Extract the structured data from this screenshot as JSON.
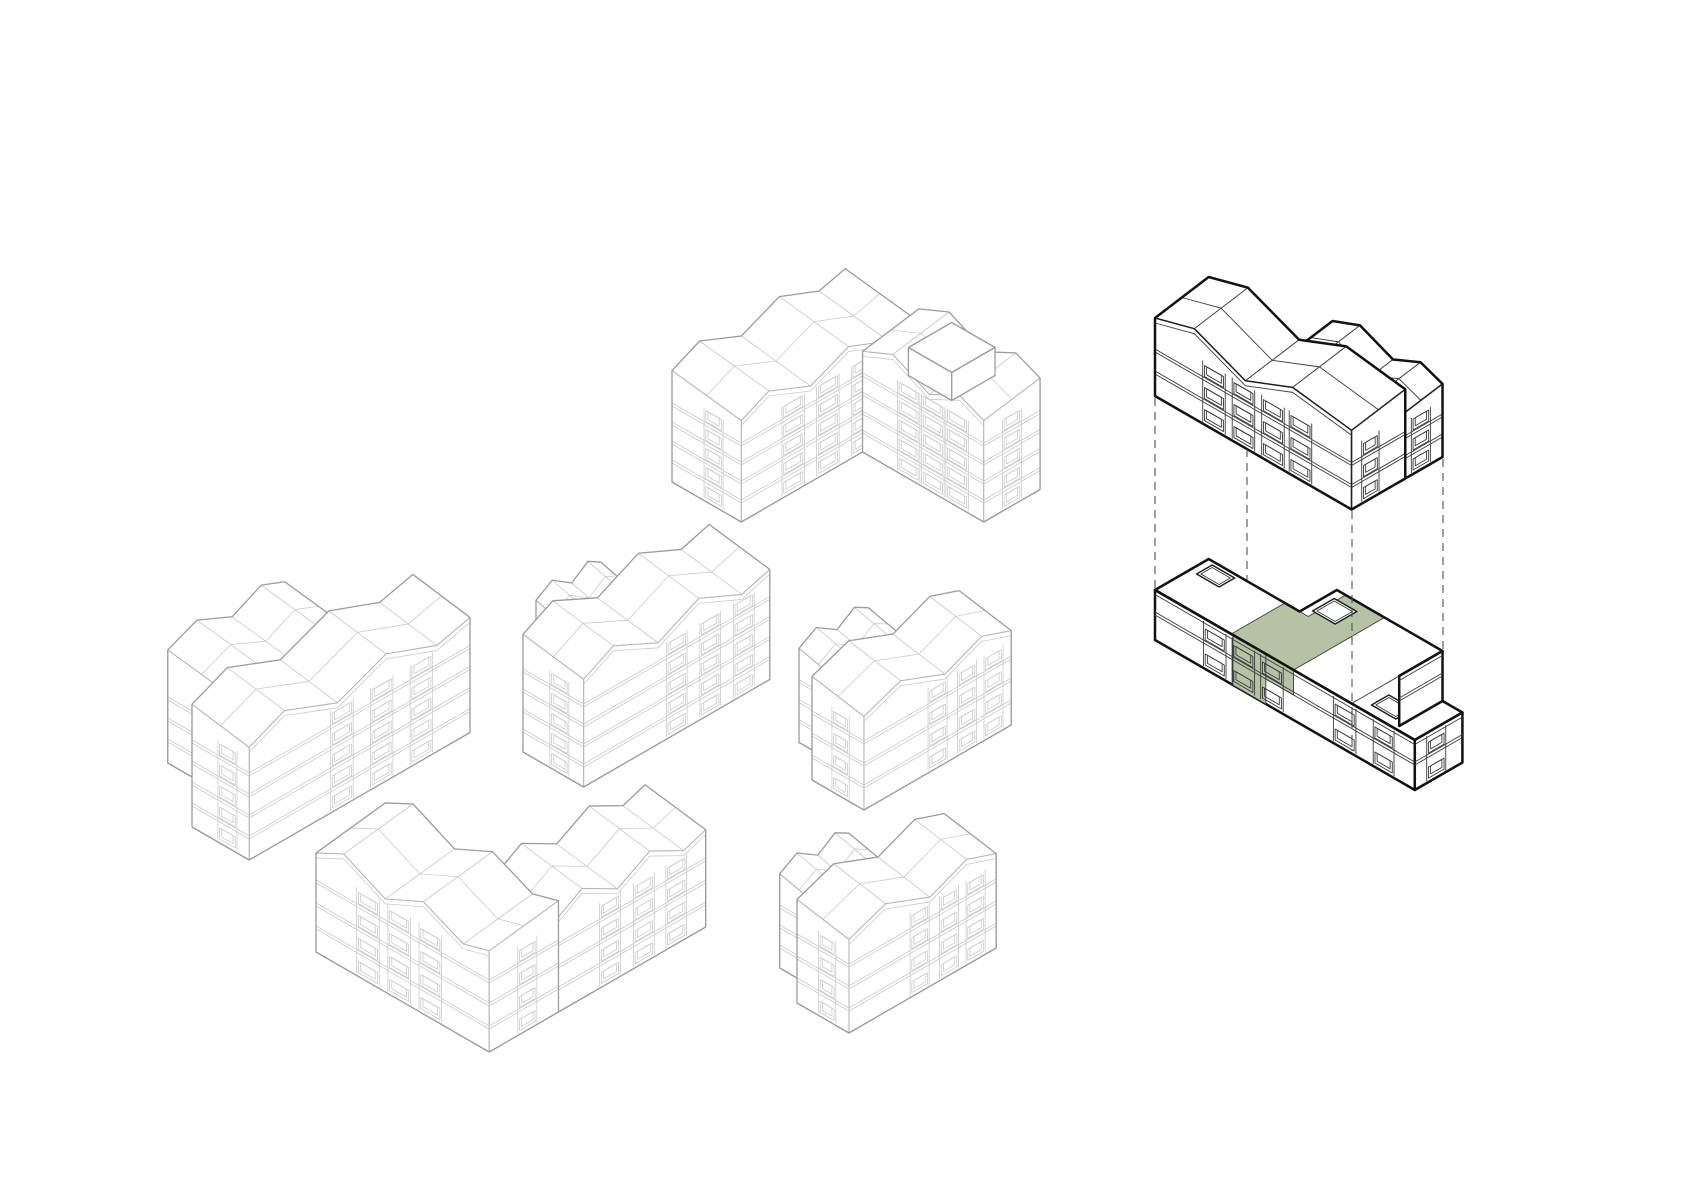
{
  "canvas": {
    "width": 1683,
    "height": 1190,
    "background": "#ffffff"
  },
  "projection": {
    "ax": 0.866,
    "ay": 0.5,
    "bx": 0.866,
    "by": -0.5
  },
  "styles": {
    "light": {
      "line": "#cbcbcb",
      "lwLine": 0.8,
      "edge": "#b4b4b4",
      "lwEdge": 1.05,
      "outline": "#9c9c9c",
      "lwOutline": 1.3
    },
    "dark": {
      "line": "#3b3b3b",
      "lwLine": 0.9,
      "edge": "#1f1f1f",
      "lwEdge": 1.5,
      "outline": "#121212",
      "lwOutline": 2.5
    },
    "highlight": {
      "fill": "#b5c2a3"
    },
    "dash": {
      "color": "#505050",
      "lw": 1.1,
      "pattern": "8 6"
    },
    "faceFill": "#ffffff"
  },
  "roof_profiles": {
    "long": [
      [
        0,
        0.32
      ],
      [
        0.16,
        1
      ],
      [
        0.4,
        0.05
      ],
      [
        0.62,
        0.92
      ],
      [
        0.85,
        0.05
      ],
      [
        1,
        0.42
      ]
    ],
    "short": [
      [
        0,
        0.28
      ],
      [
        0.25,
        1
      ],
      [
        0.55,
        0.06
      ],
      [
        0.8,
        0.88
      ],
      [
        1,
        0.32
      ]
    ],
    "gmain": [
      [
        0,
        0.5
      ],
      [
        0.2,
        1
      ],
      [
        0.46,
        0.06
      ],
      [
        0.7,
        0.92
      ],
      [
        1,
        0.55
      ]
    ]
  },
  "buildings": [
    {
      "id": "north-block",
      "style": "light",
      "anchor": [
        672,
        482
      ],
      "masses": [
        {
          "type": "slab",
          "axis": "b",
          "u": [
            0,
            200
          ],
          "v": [
            0,
            80
          ],
          "H": 95,
          "rise": 20,
          "tilt": 10,
          "floors": 5,
          "fh": 19,
          "profile": "long",
          "stacks": [
            {
              "face": "front",
              "t": 0.3,
              "hw": 13
            },
            {
              "face": "front",
              "t": 0.5,
              "hw": 13
            },
            {
              "face": "front",
              "t": 0.7,
              "hw": 13
            },
            {
              "face": "gable",
              "t": 0.4,
              "hw": 11
            }
          ]
        },
        {
          "type": "slab",
          "axis": "a",
          "u": [
            80,
            220
          ],
          "v": [
            140,
            205
          ],
          "H": 95,
          "rise": 20,
          "tilt": 10,
          "floors": 5,
          "fh": 19,
          "profile": "short",
          "stacks": [
            {
              "face": "front",
              "t": 0.38,
              "hw": 13
            },
            {
              "face": "front",
              "t": 0.58,
              "hw": 13
            },
            {
              "face": "front",
              "t": 0.78,
              "hw": 13
            },
            {
              "face": "gable",
              "t": 0.5,
              "hw": 11
            }
          ]
        },
        {
          "type": "flat",
          "outline": [
            [
              125,
              148
            ],
            [
              175,
              148
            ],
            [
              175,
              198
            ],
            [
              125,
              198
            ]
          ],
          "z0": 95,
          "H": 28,
          "floors": 0,
          "fh": 0,
          "facades": [
            {
              "a0": 125,
              "a1": 175,
              "b": 148,
              "stacks": []
            }
          ],
          "gables": [
            {
              "a": 175,
              "b0": 148,
              "b1": 198,
              "stacks": []
            }
          ]
        }
      ]
    },
    {
      "id": "west-block",
      "style": "light",
      "anchor": [
        192,
        827
      ],
      "masses": [
        {
          "type": "slab",
          "axis": "b",
          "u": [
            50,
            185
          ],
          "v": [
            -78,
            0
          ],
          "H": 98,
          "rise": 18,
          "tilt": 10,
          "floors": 4,
          "fh": 21,
          "profile": "short",
          "stacks": []
        },
        {
          "type": "slab",
          "axis": "b",
          "u": [
            0,
            255
          ],
          "v": [
            0,
            66
          ],
          "H": 105,
          "rise": 24,
          "tilt": 10,
          "floors": 5,
          "fh": 21,
          "profile": "long",
          "stacks": [
            {
              "face": "front",
              "t": 0.42,
              "hw": 13
            },
            {
              "face": "front",
              "t": 0.6,
              "hw": 13
            },
            {
              "face": "front",
              "t": 0.78,
              "hw": 13
            },
            {
              "face": "gable",
              "t": 0.38,
              "hw": 11
            }
          ]
        }
      ]
    },
    {
      "id": "center-block",
      "style": "light",
      "anchor": [
        523,
        752
      ],
      "masses": [
        {
          "type": "slab",
          "axis": "b",
          "u": [
            55,
            130
          ],
          "v": [
            -40,
            0
          ],
          "H": 90,
          "rise": 15,
          "tilt": 10,
          "floors": 4,
          "fh": 20,
          "profile": "short",
          "stacks": []
        },
        {
          "type": "slab",
          "axis": "b",
          "u": [
            0,
            215
          ],
          "v": [
            0,
            70
          ],
          "H": 100,
          "rise": 24,
          "tilt": 10,
          "floors": 5,
          "fh": 20,
          "profile": "long",
          "stacks": [
            {
              "face": "front",
              "t": 0.5,
              "hw": 12
            },
            {
              "face": "front",
              "t": 0.68,
              "hw": 12
            },
            {
              "face": "front",
              "t": 0.86,
              "hw": 12
            },
            {
              "face": "gable",
              "t": 0.4,
              "hw": 11
            }
          ]
        }
      ]
    },
    {
      "id": "east-block",
      "style": "light",
      "anchor": [
        812,
        780
      ],
      "masses": [
        {
          "type": "slab",
          "axis": "b",
          "u": [
            30,
            110
          ],
          "v": [
            -45,
            0
          ],
          "H": 80,
          "rise": 15,
          "tilt": 10,
          "floors": 4,
          "fh": 20,
          "profile": "short",
          "stacks": []
        },
        {
          "type": "slab",
          "axis": "b",
          "u": [
            0,
            170
          ],
          "v": [
            0,
            60
          ],
          "H": 88,
          "rise": 20,
          "tilt": 10,
          "floors": 4,
          "fh": 22,
          "profile": "short",
          "stacks": [
            {
              "face": "front",
              "t": 0.5,
              "hw": 11
            },
            {
              "face": "front",
              "t": 0.7,
              "hw": 11
            },
            {
              "face": "front",
              "t": 0.88,
              "hw": 11
            },
            {
              "face": "gable",
              "t": 0.45,
              "hw": 10
            }
          ]
        }
      ]
    },
    {
      "id": "southwest-block",
      "style": "light",
      "anchor": [
        316,
        952
      ],
      "masses": [
        {
          "type": "slab",
          "axis": "b",
          "u": [
            80,
            250
          ],
          "v": [
            130,
            200
          ],
          "H": 88,
          "rise": 22,
          "tilt": 10,
          "floors": 4,
          "fh": 22,
          "profile": "long",
          "stacks": [
            {
              "face": "front",
              "t": 0.35,
              "hw": 12
            },
            {
              "face": "front",
              "t": 0.58,
              "hw": 12
            },
            {
              "face": "front",
              "t": 0.8,
              "hw": 12
            }
          ]
        },
        {
          "type": "slab",
          "axis": "a",
          "u": [
            0,
            200
          ],
          "v": [
            0,
            80
          ],
          "H": 92,
          "rise": 22,
          "tilt": 10,
          "floors": 4,
          "fh": 23,
          "profile": "long",
          "stacks": [
            {
              "face": "front",
              "t": 0.3,
              "hw": 13
            },
            {
              "face": "front",
              "t": 0.48,
              "hw": 13
            },
            {
              "face": "front",
              "t": 0.66,
              "hw": 13
            },
            {
              "face": "gable",
              "t": 0.55,
              "hw": 11
            }
          ]
        }
      ]
    },
    {
      "id": "south-block",
      "style": "light",
      "anchor": [
        797,
        1003
      ],
      "masses": [
        {
          "type": "slab",
          "axis": "b",
          "u": [
            25,
            105
          ],
          "v": [
            -45,
            0
          ],
          "H": 80,
          "rise": 15,
          "tilt": 10,
          "floors": 4,
          "fh": 20,
          "profile": "short",
          "stacks": []
        },
        {
          "type": "slab",
          "axis": "b",
          "u": [
            0,
            170
          ],
          "v": [
            0,
            60
          ],
          "H": 88,
          "rise": 20,
          "tilt": 10,
          "floors": 4,
          "fh": 22,
          "profile": "short",
          "stacks": [
            {
              "face": "front",
              "t": 0.48,
              "hw": 11
            },
            {
              "face": "front",
              "t": 0.68,
              "hw": 11
            },
            {
              "face": "front",
              "t": 0.86,
              "hw": 11
            },
            {
              "face": "gable",
              "t": 0.42,
              "hw": 10
            }
          ]
        }
      ]
    },
    {
      "id": "selected-block-upper-floors",
      "style": "dark",
      "anchor": [
        1155,
        396
      ],
      "masses": [
        {
          "type": "slab",
          "axis": "a",
          "u": [
            100,
            227
          ],
          "v": [
            55,
            105
          ],
          "H": 60,
          "rise": 16,
          "tilt": 8,
          "floors": 3,
          "fh": 20,
          "profile": "short",
          "stacks": [
            {
              "face": "gable",
              "t": 0.5,
              "hw": 11
            }
          ]
        },
        {
          "type": "slab",
          "axis": "a",
          "u": [
            0,
            227
          ],
          "v": [
            0,
            62
          ],
          "H": 66,
          "rise": 24,
          "tilt": 10,
          "floors": 3,
          "fh": 22,
          "profile": "gmain",
          "stacks": [
            {
              "face": "front",
              "t": 0.3,
              "hw": 13
            },
            {
              "face": "front",
              "t": 0.45,
              "hw": 13
            },
            {
              "face": "front",
              "t": 0.6,
              "hw": 13
            },
            {
              "face": "front",
              "t": 0.74,
              "hw": 13
            },
            {
              "face": "gable",
              "t": 0.35,
              "hw": 10
            }
          ]
        }
      ]
    },
    {
      "id": "selected-block-base",
      "style": "dark",
      "anchor": [
        1155,
        640
      ],
      "masses": [
        {
          "type": "flat",
          "outline": [
            [
              0,
              0
            ],
            [
              300,
              0
            ],
            [
              300,
              55
            ],
            [
              227,
              55
            ],
            [
              227,
              105
            ],
            [
              105,
              105
            ],
            [
              105,
              62
            ],
            [
              0,
              62
            ]
          ],
          "H": 50,
          "floors": 2,
          "fh": 25,
          "topLines": [
            [
              227,
              0,
              227,
              55
            ]
          ],
          "facades": [
            {
              "a0": 0,
              "a1": 300,
              "b": 0,
              "stacks": [
                {
                  "t": 0.23,
                  "hw": 13
                },
                {
                  "t": 0.34,
                  "hw": 13
                },
                {
                  "t": 0.45,
                  "hw": 13
                },
                {
                  "t": 0.73,
                  "hw": 13
                },
                {
                  "t": 0.88,
                  "hw": 12
                }
              ]
            }
          ],
          "gables": [
            {
              "a": 227,
              "b0": 55,
              "b1": 105,
              "stacks": []
            },
            {
              "a": 300,
              "b0": 0,
              "b1": 55,
              "stacks": [
                {
                  "t": 0.45,
                  "hw": 11
                }
              ]
            }
          ],
          "green": {
            "facadeOn": 0,
            "top": [
              [
                88,
                0
              ],
              [
                160,
                0
              ],
              [
                160,
                105
              ],
              [
                115,
                105
              ],
              [
                115,
                62
              ],
              [
                88,
                62
              ]
            ],
            "facade": [
              [
                90,
                0,
                128,
                50
              ],
              [
                128,
                25,
                160,
                50
              ]
            ],
            "lines": [
              [
                88,
                0,
                88,
                62
              ],
              [
                160,
                0,
                160,
                105
              ],
              [
                88,
                62,
                115,
                62
              ],
              [
                115,
                62,
                115,
                105
              ]
            ]
          },
          "bulkheads": [
            [
              8,
              40,
              34,
              58
            ],
            [
              112,
              70,
              138,
              95
            ],
            [
              240,
              10,
              268,
              30
            ]
          ]
        }
      ]
    }
  ],
  "dashed_lines": [
    {
      "x": 1155,
      "y1": 398,
      "y2": 588
    },
    {
      "x": 1247,
      "y1": 449,
      "y2": 580
    },
    {
      "x": 1352,
      "y1": 511,
      "y2": 751
    },
    {
      "x": 1443,
      "y1": 459,
      "y2": 649
    }
  ]
}
